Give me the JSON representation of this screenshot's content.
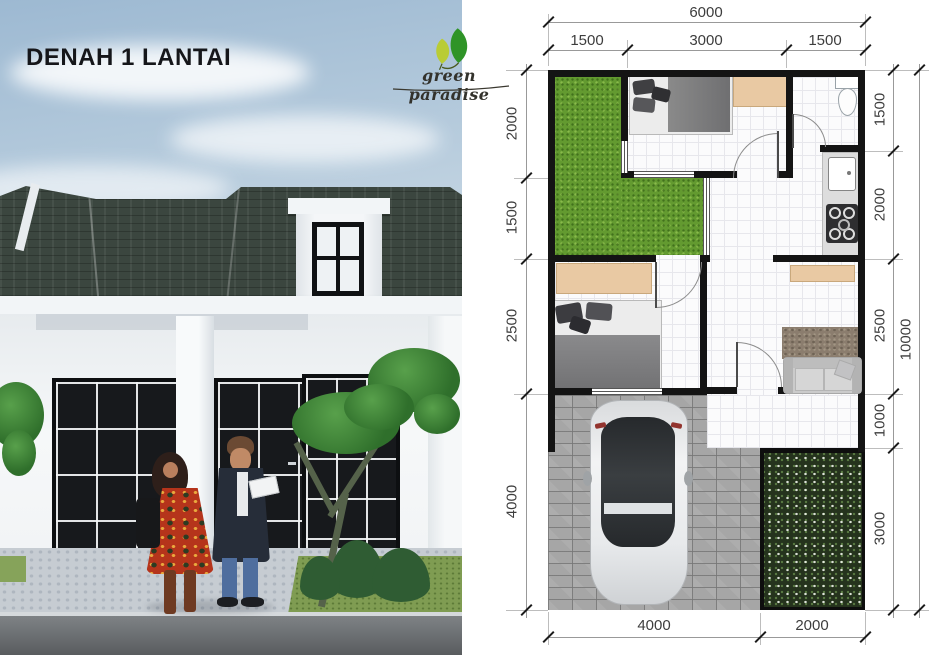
{
  "header": {
    "title": "DENAH 1 LANTAI"
  },
  "logo": {
    "name": "green paradise",
    "icon": "leaf-icon"
  },
  "floor_plan": {
    "dimensions": {
      "top_total": "6000",
      "top_segments": [
        "1500",
        "3000",
        "1500"
      ],
      "left_segments": [
        "2000",
        "1500",
        "2500",
        "4000"
      ],
      "right_segments": [
        "1500",
        "2000",
        "2500",
        "1000",
        "3000"
      ],
      "right_total": "10000",
      "bottom_segments": [
        "4000",
        "2000"
      ]
    },
    "colors": {
      "wall": "#141414",
      "lawn_green": "#639a30",
      "garden_dark": "#25331d",
      "paving_gray": "#a6a6a6",
      "cabinet_tan": "#e9c9a3",
      "leaf_green": "#2f9427",
      "leaf_yellow": "#b9cc35"
    }
  }
}
